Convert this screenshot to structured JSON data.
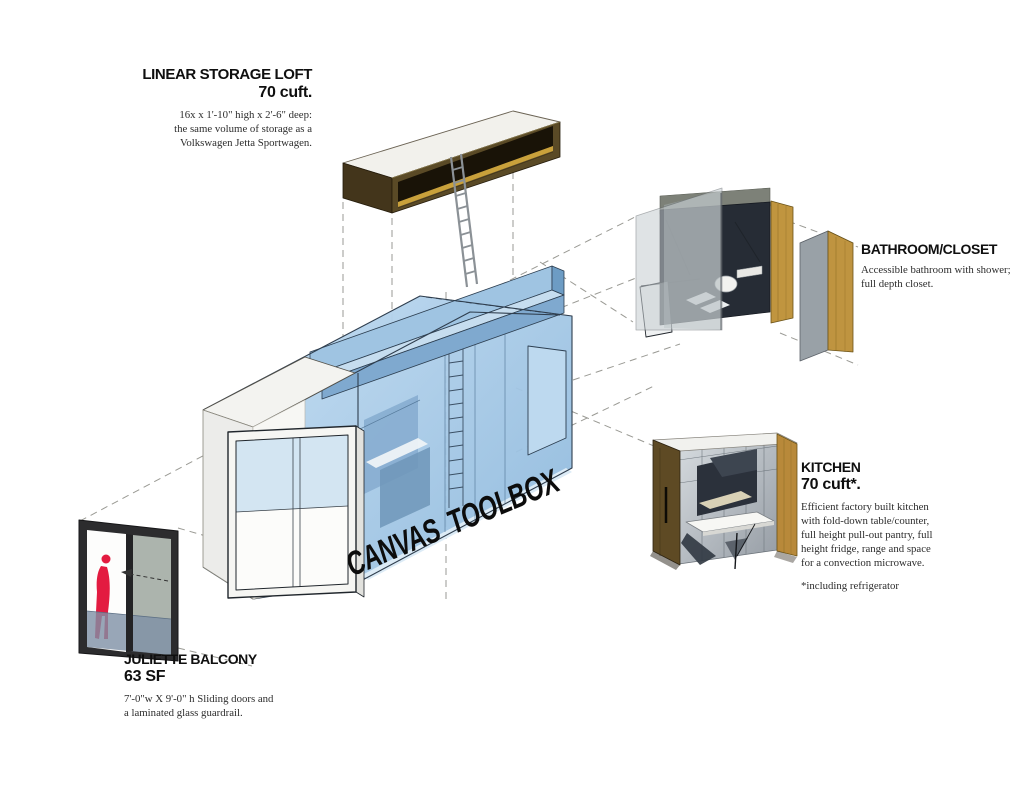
{
  "title": "CANVAS TOOLBOX",
  "colors": {
    "unit_blue": "#a5c8e4",
    "unit_blue_dark": "#7fa9cf",
    "wood_oak": "#bf9440",
    "wood_dark": "#5e4a24",
    "figure_red": "#e31b40",
    "dashed_line_grey": "#9a9a94",
    "ink": "#111111"
  },
  "callouts": {
    "storage_loft": {
      "heading": "LINEAR STORAGE LOFT",
      "value": "70 cuft.",
      "line1": "16x x 1'-10\" high x 2'-6\" deep:",
      "line2": "the same volume of storage as a",
      "line3": "Volkswagen Jetta Sportwagen."
    },
    "bathroom": {
      "heading": "BATHROOM/CLOSET",
      "line1": "Accessible bathroom with shower;",
      "line2": "full depth closet."
    },
    "kitchen": {
      "heading": "KITCHEN",
      "value": "70 cuft*.",
      "body": "Efficient factory built kitchen with fold-down table/counter, full height pull-out pantry, full height fridge, range and space for a convection microwave.",
      "footnote": "*including refrigerator"
    },
    "balcony": {
      "heading": "JULIETTE BALCONY",
      "value": "63 SF",
      "line1": "7'-0\"w X 9'-0\" h Sliding doors and",
      "line2": "a laminated glass guardrail."
    }
  }
}
